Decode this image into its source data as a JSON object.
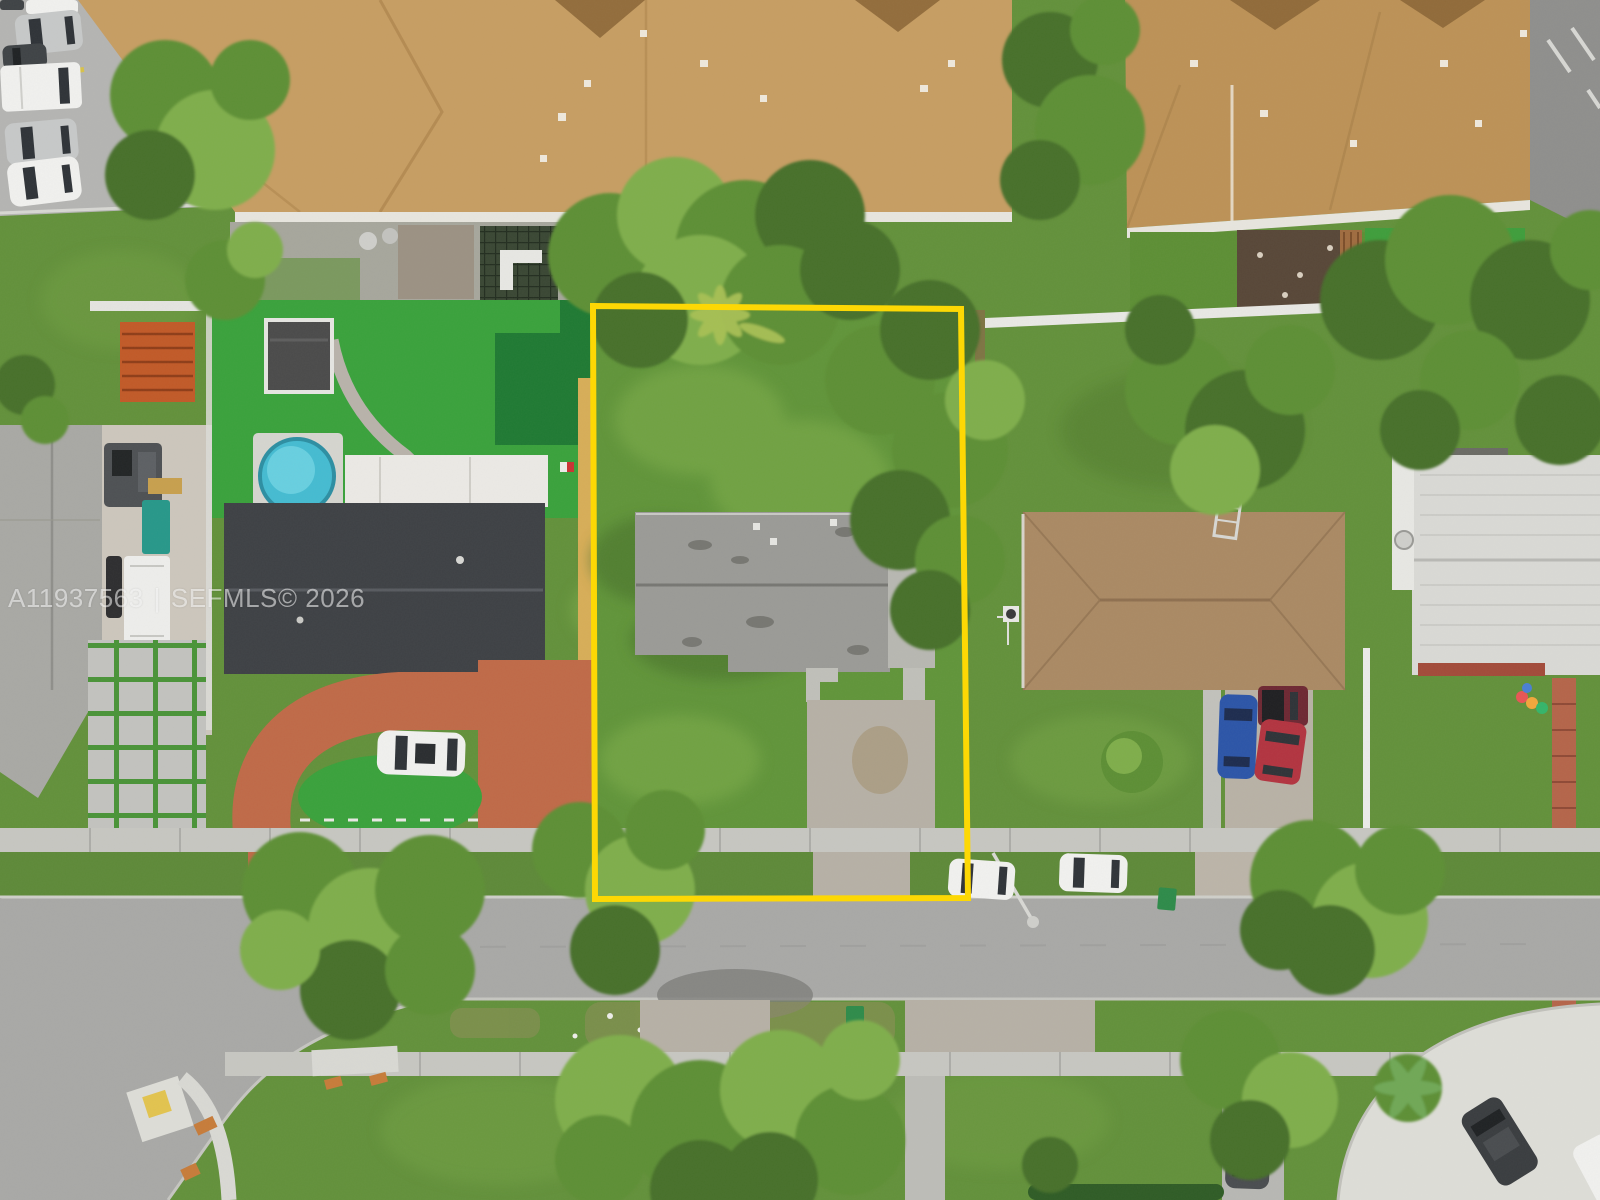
{
  "watermark": {
    "listing_id": "A11937563",
    "separator": "|",
    "mls_credit": "SEFMLS© 2026",
    "full_text": "A11937563 | SEFMLS© 2026"
  },
  "colors": {
    "boundary-yellow": "#ffd900",
    "watermark-white": "rgba(255,255,255,0.55)",
    "roof-tan": "#c79e63",
    "roof-tan-2": "#bd9257",
    "roof-subject-gray": "#9b9b97",
    "roof-dark-charcoal": "#3e4145",
    "roof-white-tile": "#dadad6",
    "roof-brown": "#ab8a64",
    "roof-light-gray": "#a9a9a5",
    "lawn-green": "#63913b",
    "turf-green": "#3aa23c",
    "tree-light": "#7fae4b",
    "tree-mid": "#5d8f35",
    "tree-dark": "#47702a",
    "street-asphalt": "#a9a9a7",
    "sidewalk-concrete": "#c7c7c2",
    "driveway-concrete": "#b7b1a6",
    "terracotta-driveway": "#c06a48",
    "pool-blue": "#45bcd2",
    "gravel": "#cdc7bd",
    "paver-gray": "#c3c3bf",
    "car-white": "#f1f1ef",
    "car-silver": "#c7c9c9",
    "car-blue": "#2c55a8",
    "car-red": "#b33440",
    "car-maroon": "#6e2833"
  }
}
